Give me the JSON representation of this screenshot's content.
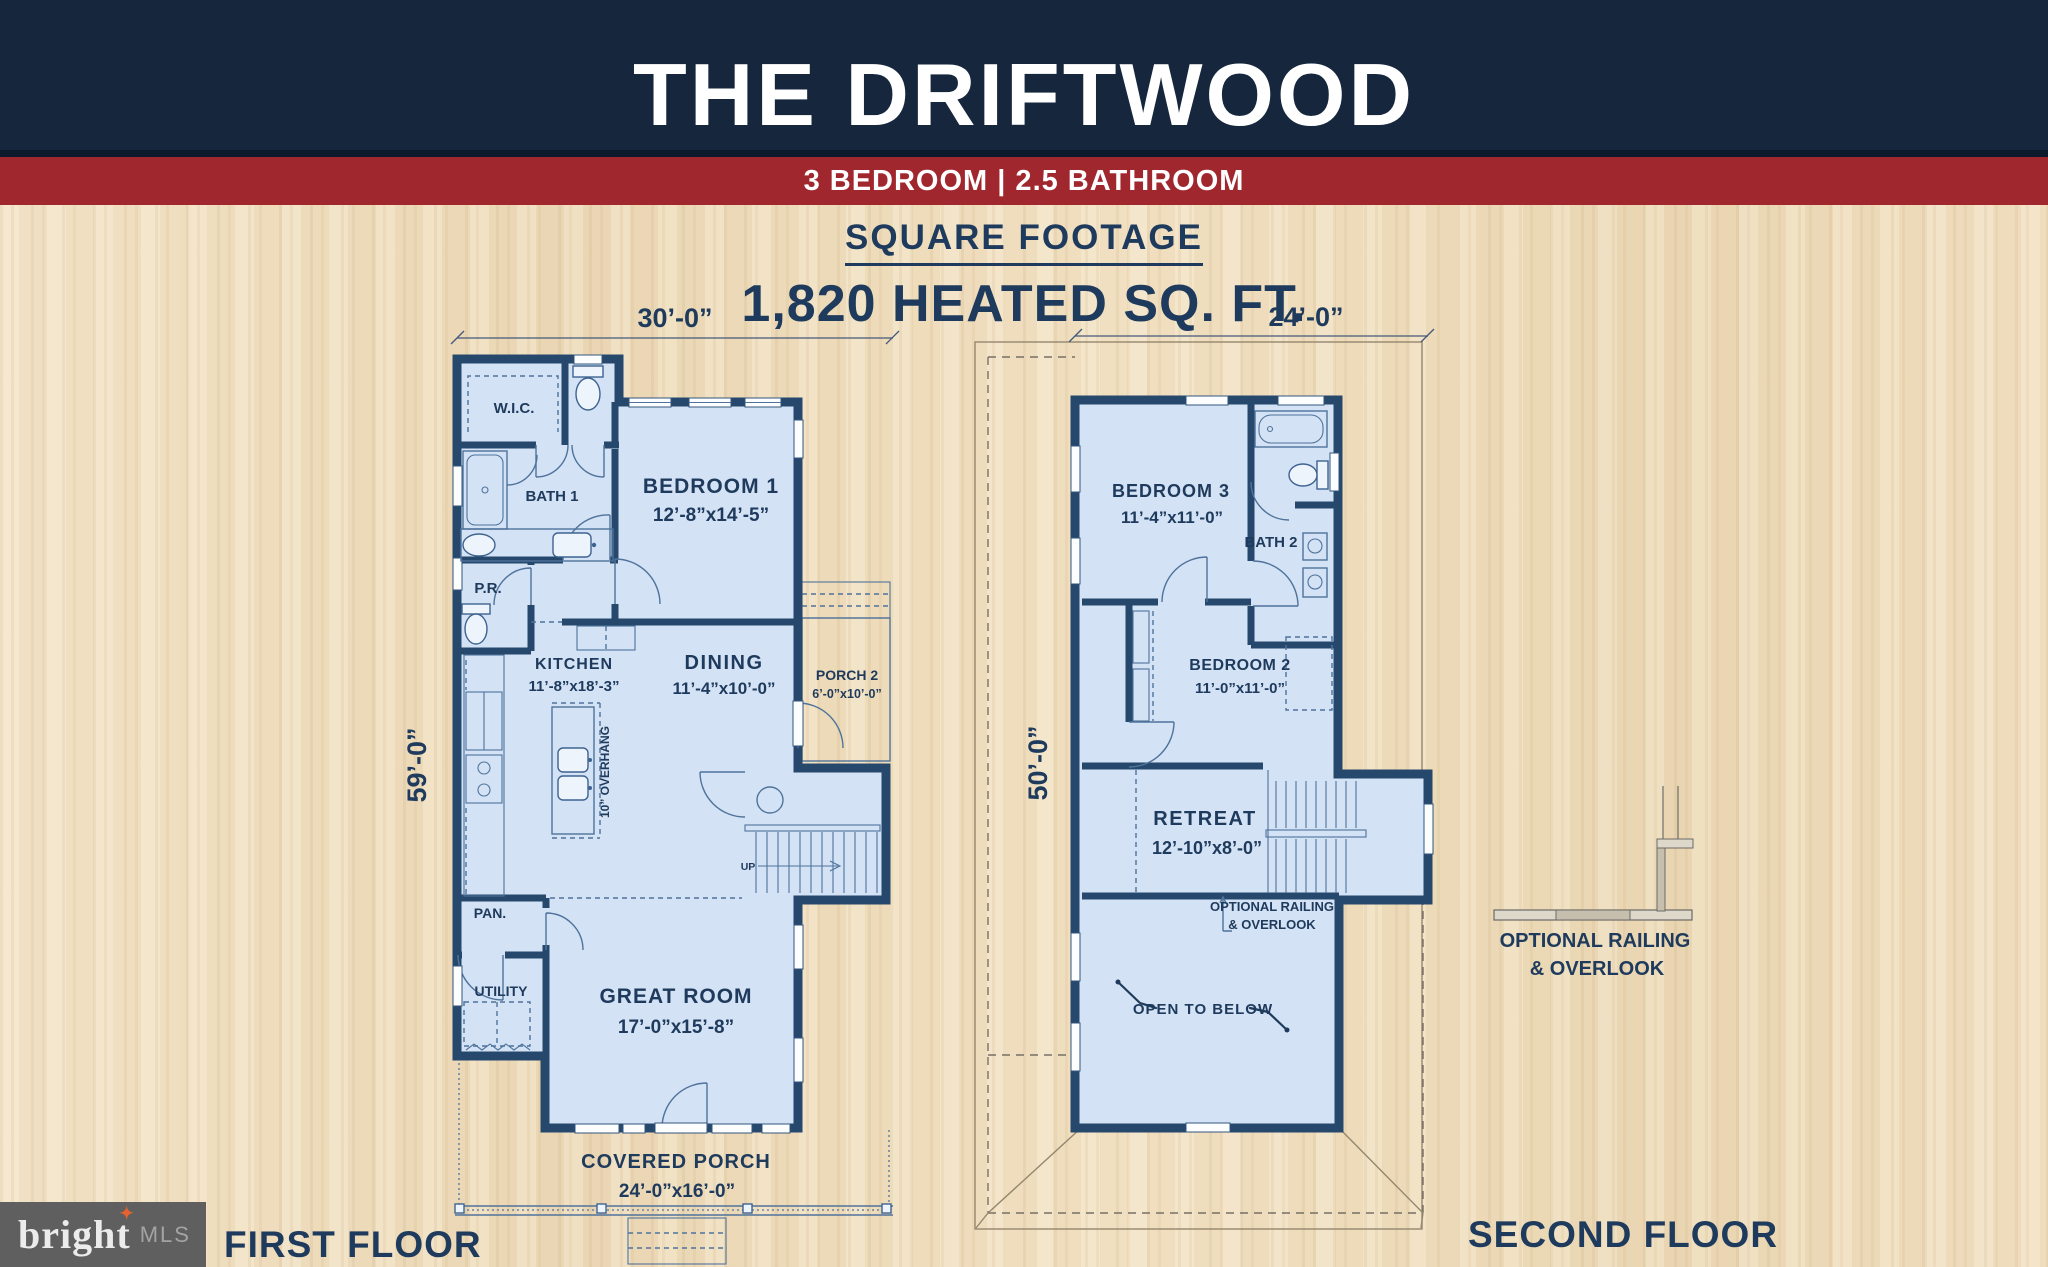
{
  "header": {
    "title": "THE DRIFTWOOD",
    "subtitle": "3 BEDROOM | 2.5 BATHROOM"
  },
  "square_footage": {
    "heading": "SQUARE FOOTAGE",
    "value": "1,820 HEATED SQ. FT."
  },
  "first_floor": {
    "label": "FIRST FLOOR",
    "width_dim": "30’-0”",
    "height_dim": "59’-0”",
    "rooms": {
      "wic": "W.I.C.",
      "bath1": "BATH 1",
      "pr": "P.R.",
      "pan": "PAN.",
      "utility": "UTILITY",
      "bedroom1": {
        "name": "BEDROOM 1",
        "dims": "12’-8”x14’-5”"
      },
      "kitchen": {
        "name": "KITCHEN",
        "dims": "11’-8”x18’-3”"
      },
      "dining": {
        "name": "DINING",
        "dims": "11’-4”x10’-0”"
      },
      "porch2": {
        "name": "PORCH 2",
        "dims": "6’-0”x10’-0”"
      },
      "great_room": {
        "name": "GREAT ROOM",
        "dims": "17’-0”x15’-8”"
      },
      "covered_porch": {
        "name": "COVERED PORCH",
        "dims": "24’-0”x16’-0”"
      }
    },
    "notes": {
      "overhang": "10” OVERHANG",
      "up": "UP"
    }
  },
  "second_floor": {
    "label": "SECOND FLOOR",
    "width_dim": "24’-0”",
    "height_dim": "50’-0”",
    "rooms": {
      "bedroom3": {
        "name": "BEDROOM 3",
        "dims": "11’-4”x11’-0”"
      },
      "bath2": "BATH 2",
      "bedroom2": {
        "name": "BEDROOM 2",
        "dims": "11’-0”x11’-0”"
      },
      "retreat": {
        "name": "RETREAT",
        "dims": "12’-10”x8’-0”"
      },
      "open_below": "OPEN TO BELOW"
    },
    "notes": {
      "railing1": "OPTIONAL RAILING",
      "railing2": "& OVERLOOK"
    }
  },
  "railing_detail": {
    "line1": "OPTIONAL RAILING",
    "line2": "& OVERLOOK"
  },
  "logo": {
    "brand": "bright",
    "star": "✦",
    "suffix": "MLS"
  },
  "colors": {
    "header_navy": "#15263d",
    "banner_red": "#a1272f",
    "wall_navy": "#26486d",
    "room_fill": "#d3e2f4",
    "text_navy": "#1e3a5c",
    "wood": "#eedcbd",
    "logo_gray": "#5f5f5f",
    "logo_star_orange": "#e8622d"
  }
}
